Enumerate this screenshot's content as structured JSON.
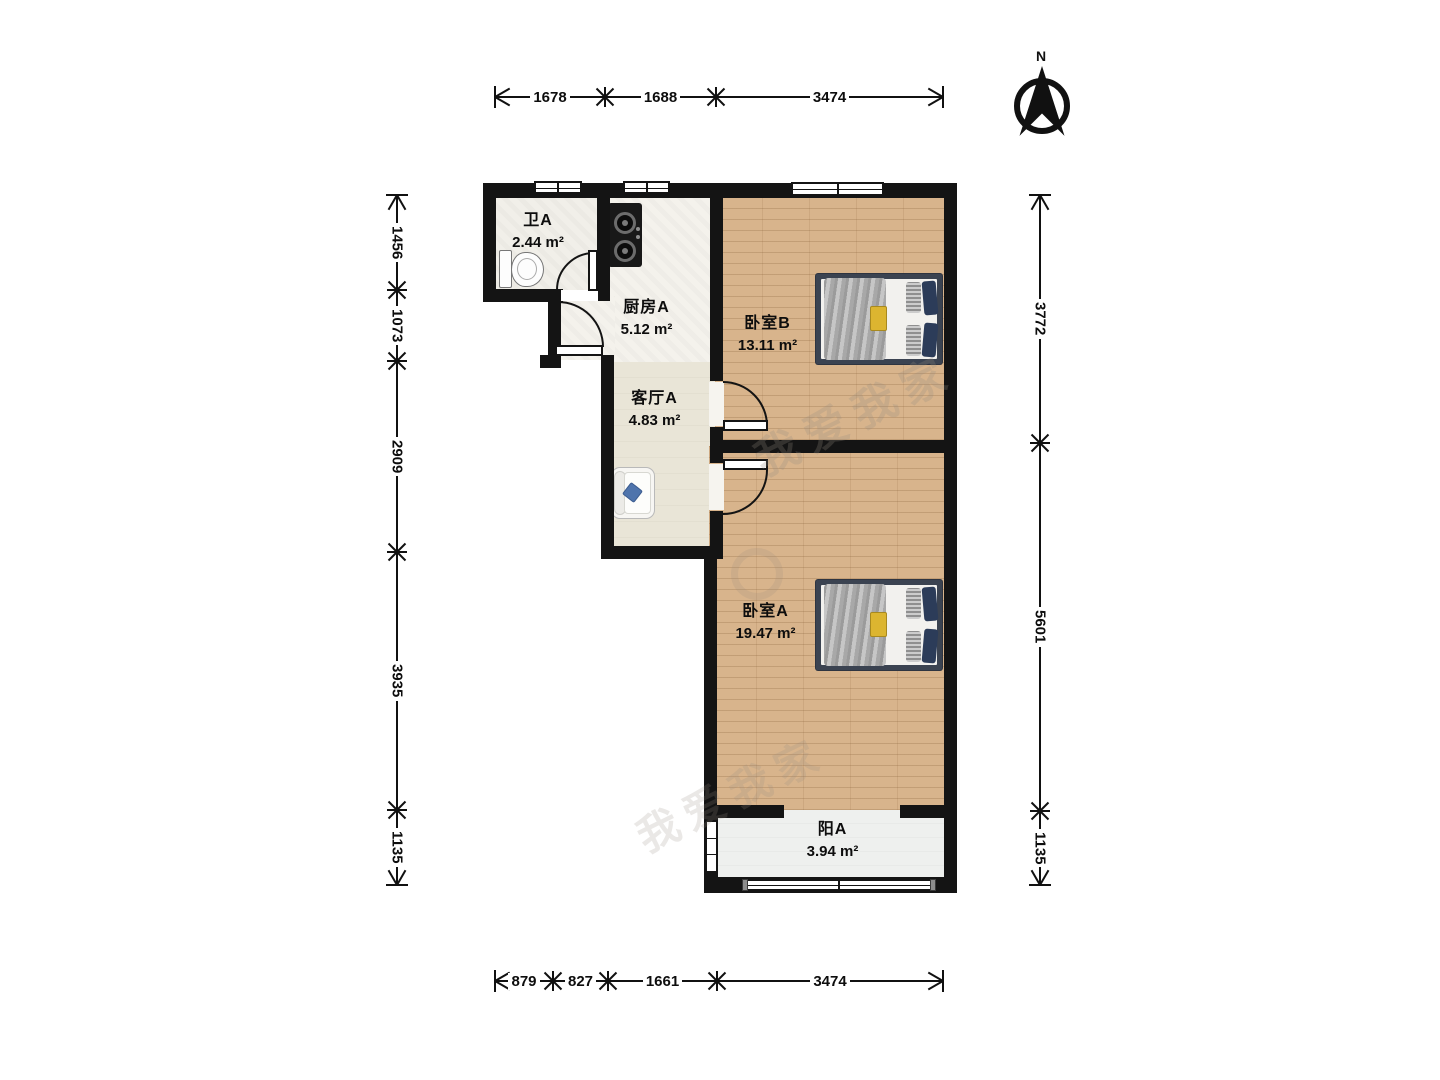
{
  "compass": {
    "label": "N"
  },
  "rooms": [
    {
      "name": "卫A",
      "area": "2.44 m²"
    },
    {
      "name": "厨房A",
      "area": "5.12 m²"
    },
    {
      "name": "客厅A",
      "area": "4.83 m²"
    },
    {
      "name": "卧室B",
      "area": "13.11 m²"
    },
    {
      "name": "卧室A",
      "area": "19.47 m²"
    },
    {
      "name": "阳A",
      "area": "3.94 m²"
    }
  ],
  "dims": [
    {
      "name": "dim-top",
      "dir": "h",
      "line": 97,
      "points": [
        495,
        605,
        716,
        943
      ],
      "labels": [
        "1678",
        "1688",
        "3474"
      ]
    },
    {
      "name": "dim-bottom",
      "dir": "h",
      "line": 981,
      "points": [
        495,
        553,
        608,
        717,
        943
      ],
      "labels": [
        "879",
        "827",
        "1661",
        "3474"
      ]
    },
    {
      "name": "dim-left",
      "dir": "v",
      "line": 397,
      "points": [
        195,
        290,
        361,
        552,
        810,
        885
      ],
      "labels": [
        "1456",
        "1073",
        "2909",
        "3935",
        "1135"
      ]
    },
    {
      "name": "dim-right",
      "dir": "v",
      "line": 1040,
      "points": [
        195,
        443,
        811,
        885
      ],
      "labels": [
        "3772",
        "5601",
        "1135"
      ]
    }
  ],
  "watermark": {
    "text": "我爱我家"
  },
  "colors": {
    "wall": "#141414",
    "wood_floor": "#d8b48c",
    "kitchen_floor": "#f4f2ec",
    "living_floor": "#e9e5d7",
    "balcony_floor": "#eef0ee",
    "pillow_navy": "#2c3c59",
    "tray_yellow": "#dcb530",
    "sofa_pillow_blue": "#4f74ac"
  }
}
